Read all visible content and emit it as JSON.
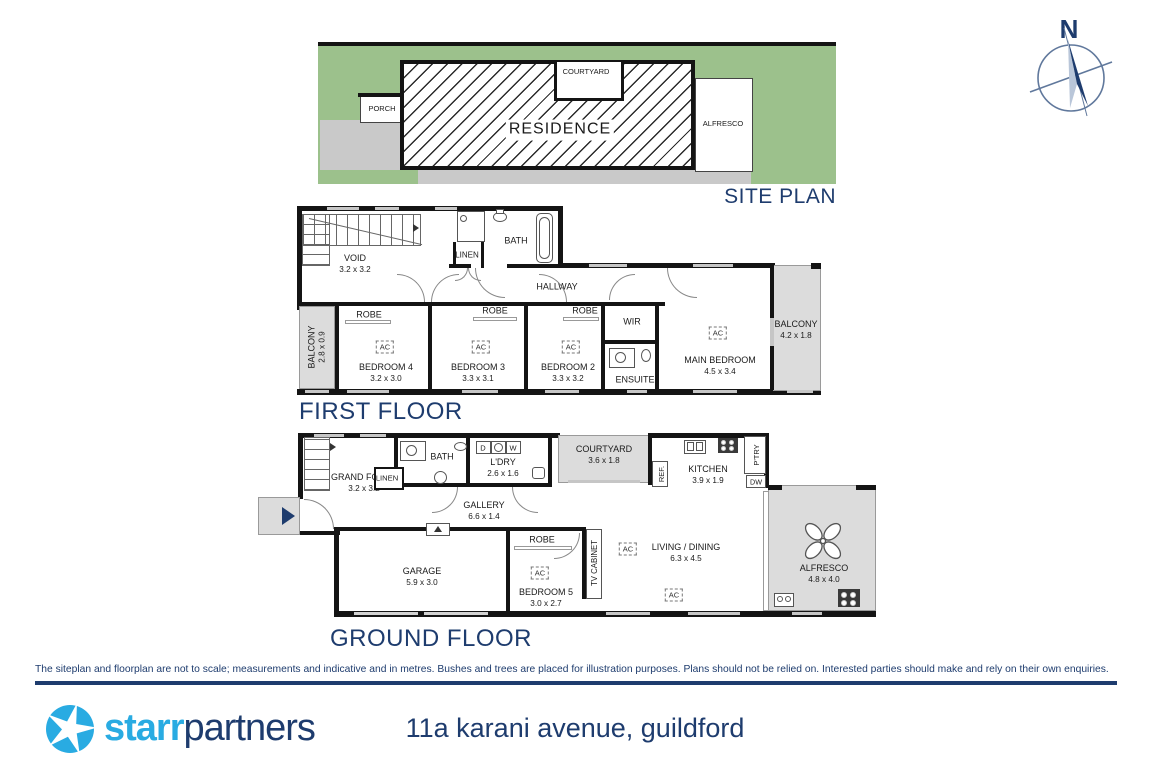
{
  "compass": {
    "north": "N"
  },
  "site_plan": {
    "title": "SITE PLAN",
    "residence": "RESIDENCE",
    "porch": "PORCH",
    "courtyard": "COURTYARD",
    "alfresco": "ALFRESCO"
  },
  "first_floor": {
    "title": "FIRST FLOOR",
    "void": {
      "name": "VOID",
      "dims": "3.2 x 3.2"
    },
    "bath": "BATH",
    "linen": "LINEN",
    "hallway": "HALLWAY",
    "balcony_left": {
      "name": "BALCONY",
      "dims": "2.8 x 0.9"
    },
    "balcony_right": {
      "name": "BALCONY",
      "dims": "4.2 x 1.8"
    },
    "robe": "ROBE",
    "ac": "AC",
    "bedroom4": {
      "name": "BEDROOM 4",
      "dims": "3.2 x 3.0"
    },
    "bedroom3": {
      "name": "BEDROOM 3",
      "dims": "3.3 x 3.1"
    },
    "bedroom2": {
      "name": "BEDROOM 2",
      "dims": "3.3 x 3.2"
    },
    "wir": "WIR",
    "ensuite": "ENSUITE",
    "main_bedroom": {
      "name": "MAIN BEDROOM",
      "dims": "4.5 x 3.4"
    }
  },
  "ground_floor": {
    "title": "GROUND FLOOR",
    "grand_foyer": {
      "name": "GRAND FOYER",
      "dims": "3.2 x 3.2"
    },
    "bath": "BATH",
    "linen": "LINEN",
    "ldry": {
      "name": "L'DRY",
      "dims": "2.6 x 1.6"
    },
    "dryer": "D",
    "washer": "W",
    "courtyard": {
      "name": "COURTYARD",
      "dims": "3.6 x 1.8"
    },
    "fridge": "REF.",
    "kitchen": {
      "name": "KITCHEN",
      "dims": "3.9 x 1.9"
    },
    "pantry": "P'TRY",
    "dishwasher": "DW",
    "gallery": {
      "name": "GALLERY",
      "dims": "6.6 x 1.4"
    },
    "garage": {
      "name": "GARAGE",
      "dims": "5.9 x 3.0"
    },
    "robe": "ROBE",
    "bedroom5": {
      "name": "BEDROOM 5",
      "dims": "3.0 x 2.7"
    },
    "tv_cabinet": "TV CABINET",
    "living_dining": {
      "name": "LIVING / DINING",
      "dims": "6.3 x 4.5"
    },
    "alfresco": {
      "name": "ALFRESCO",
      "dims": "4.8 x 4.0"
    },
    "ac": "AC"
  },
  "disclaimer": "The siteplan and floorplan are not to scale; measurements and indicative and in metres. Bushes and trees are placed for illustration purposes. Plans should not be relied on. Interested parties should make and rely on their own enquiries.",
  "footer": {
    "brand_starr": "starr",
    "brand_partners": "partners",
    "address": "11a karani avenue, guildford"
  },
  "colors": {
    "navy": "#1e3c6e",
    "brand_blue": "#29abe2",
    "site_green": "#9cc18c",
    "paved_gray": "#c9c9c9",
    "deck_gray": "#dcdcdc",
    "wall_black": "#141414"
  }
}
